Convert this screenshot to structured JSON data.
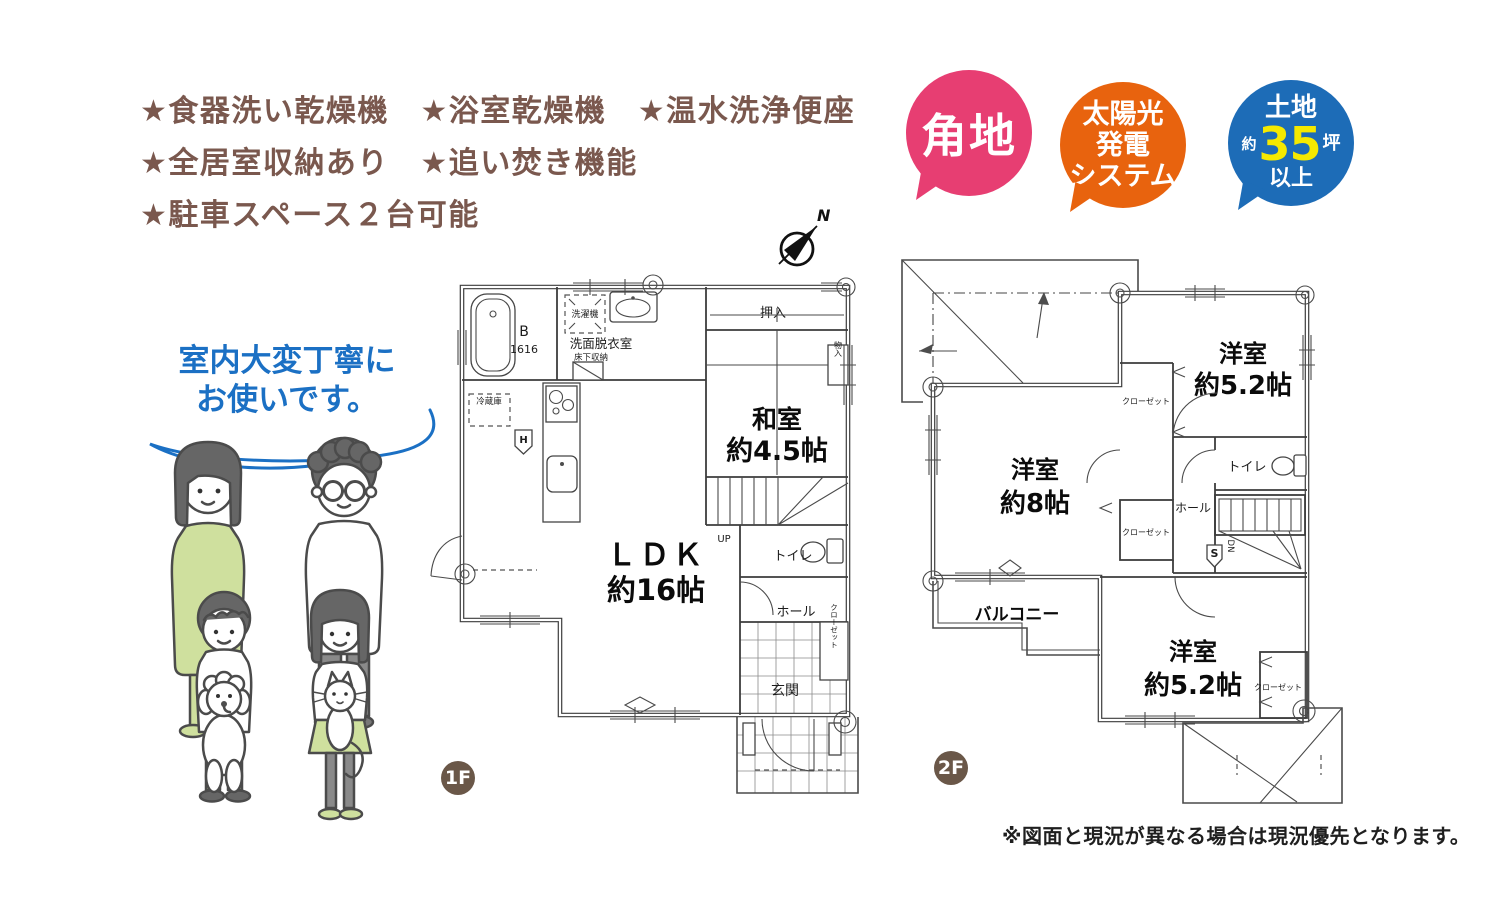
{
  "colors": {
    "feature_text": "#7a584e",
    "badge_corner": "#e73e72",
    "badge_solar": "#e8630e",
    "badge_land": "#1d6cb7",
    "land_number": "#f5e900",
    "speech_blue": "#1b70c4",
    "floor_badge": "#6a5748",
    "illustration_green": "#cfe09e"
  },
  "features": {
    "lines": [
      "★食器洗い乾燥機　★浴室乾燥機　★温水洗浄便座",
      "★全居室収納あり　★追い焚き機能",
      "★駐車スペース２台可能"
    ]
  },
  "badges": {
    "corner": {
      "label": "角地"
    },
    "solar": {
      "line1": "太陽光",
      "line2": "発電",
      "line3": "システム"
    },
    "land": {
      "top": "土地",
      "approx": "約",
      "number": "35",
      "unit": "坪",
      "bottom": "以上"
    }
  },
  "speech": {
    "line1": "室内大変丁寧に",
    "line2": "お使いです。"
  },
  "compass": {
    "north": "N"
  },
  "floor1": {
    "badge": "1F",
    "labels": {
      "bath": "B",
      "bath_size": "1616",
      "washer": "洗濯機",
      "washroom": "洗面脱衣室",
      "underfloor": "床下収納",
      "fridge": "冷蔵庫",
      "boiler": "H",
      "oshiire": "押入",
      "storage": "物入",
      "washitsu": "和室",
      "washitsu_size": "約4.5帖",
      "ldk": "ＬＤＫ",
      "ldk_size": "約16帖",
      "up": "UP",
      "toilet": "トイレ",
      "hall": "ホール",
      "closet": "クローゼット",
      "entrance": "玄関"
    }
  },
  "floor2": {
    "badge": "2F",
    "labels": {
      "room_top": "洋室",
      "room_top_size": "約5.2帖",
      "room_left": "洋室",
      "room_left_size": "約8帖",
      "room_bottom": "洋室",
      "room_bottom_size": "約5.2帖",
      "toilet": "トイレ",
      "hall": "ホール",
      "closet_top": "クローゼット",
      "closet_mid": "クローゼット",
      "closet_bottom": "クローゼット",
      "stair_s": "S",
      "down": "DN",
      "balcony": "バルコニー"
    }
  },
  "disclaimer": "※図面と現況が異なる場合は現況優先となります。"
}
